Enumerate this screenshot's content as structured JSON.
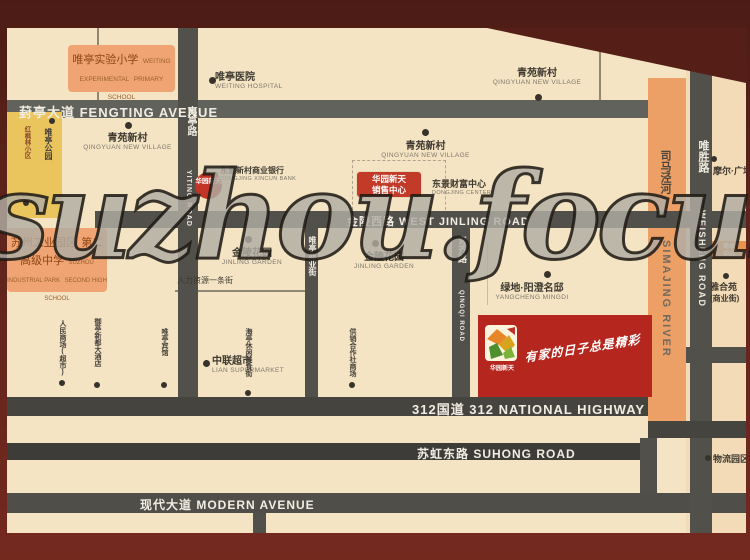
{
  "watermark": "suzhou.focus.c",
  "roads": {
    "fengting": "葑亭大道 FENGTING AVENUE",
    "jinling": "金陵西路 WEST JINLING ROAD",
    "g312": "312国道 312 NATIONAL HIGHWAY",
    "suhong": "苏虹东路 SUHONG ROAD",
    "modern": "现代大道 MODERN AVENUE",
    "yiting_cn": "夷亭路",
    "yiting_en": "YITING ROAD",
    "shangyejie_cn": "唯亭商业街",
    "qingqi_cn": "青齐路",
    "qingqi_en": "QINGQI ROAD",
    "weisheng_cn": "唯胜路",
    "weisheng_en": "WEISHENG ROAD",
    "simajing_cn": "司马泾河",
    "simajing_en": "SIMAJING RIVER"
  },
  "pois": {
    "primary_school": {
      "cn": "唯亭实验小学",
      "en1": "WEITING EXPERIMENTAL",
      "en2": "PRIMARY SCHOOL"
    },
    "hospital": {
      "cn": "唯亭医院",
      "en": "WEITING HOSPITAL"
    },
    "qingyuan": {
      "cn": "青苑新村",
      "en": "QINGYUAN NEW VILLAGE"
    },
    "bank": {
      "cn": "东景新村商业银行",
      "en": "DONGJING XINCUN BANK"
    },
    "fortune_center": {
      "cn": "东景财富中心",
      "en": "DONGJING CENTER"
    },
    "high_school": {
      "cn1": "苏州工业园区",
      "cn2": "第二高级中学",
      "en1": "SUZHOU INDUSTRIAL PARK",
      "en2": "SECOND HIGH SCHOOL"
    },
    "jinling_garden": {
      "cn": "金陵花园",
      "en": "JINLING GARDEN"
    },
    "hr_street": {
      "cn": "人力资源一条街"
    },
    "supermarket": {
      "cn": "中联超市",
      "en": "LIAN SUPERMARKET"
    },
    "v_label_a": {
      "cn": "人民商场(超市)"
    },
    "v_label_b": {
      "cn": "御亭新都大酒店"
    },
    "v_label_c": {
      "cn": "唯亭宾馆"
    },
    "v_label_d": {
      "cn": "海亭休闲美食街"
    },
    "v_label_e": {
      "cn": "供销合作社商场"
    },
    "yangcheng": {
      "cn": "绿地·阳澄名邸",
      "en": "YANGCHENG MINGDI"
    },
    "moer": {
      "cn": "摩尔·广场"
    },
    "shangye_box": {
      "line1": "商业",
      "line2": "中心"
    },
    "yaheyuan": {
      "cn": "雅合苑",
      "cn2": "(商业街)"
    },
    "logistics": {
      "cn": "物流园区"
    },
    "park": {
      "cn": "唯亭公园"
    },
    "maple": {
      "cn": "红枫林小区"
    }
  },
  "project": {
    "badge": "华园新天",
    "sales_line1": "华园新天",
    "sales_line2": "销售中心",
    "logo_name": "华园新天",
    "slogan": "有家的日子总是精彩"
  },
  "colors": {
    "map_bg": "#f4e4c4",
    "road": "#52504a",
    "river": "#eda066",
    "frame": "#5e241c",
    "banner_red": "#b5271e",
    "box_orange": "#f0a473",
    "box_yellow": "#eac45c"
  }
}
